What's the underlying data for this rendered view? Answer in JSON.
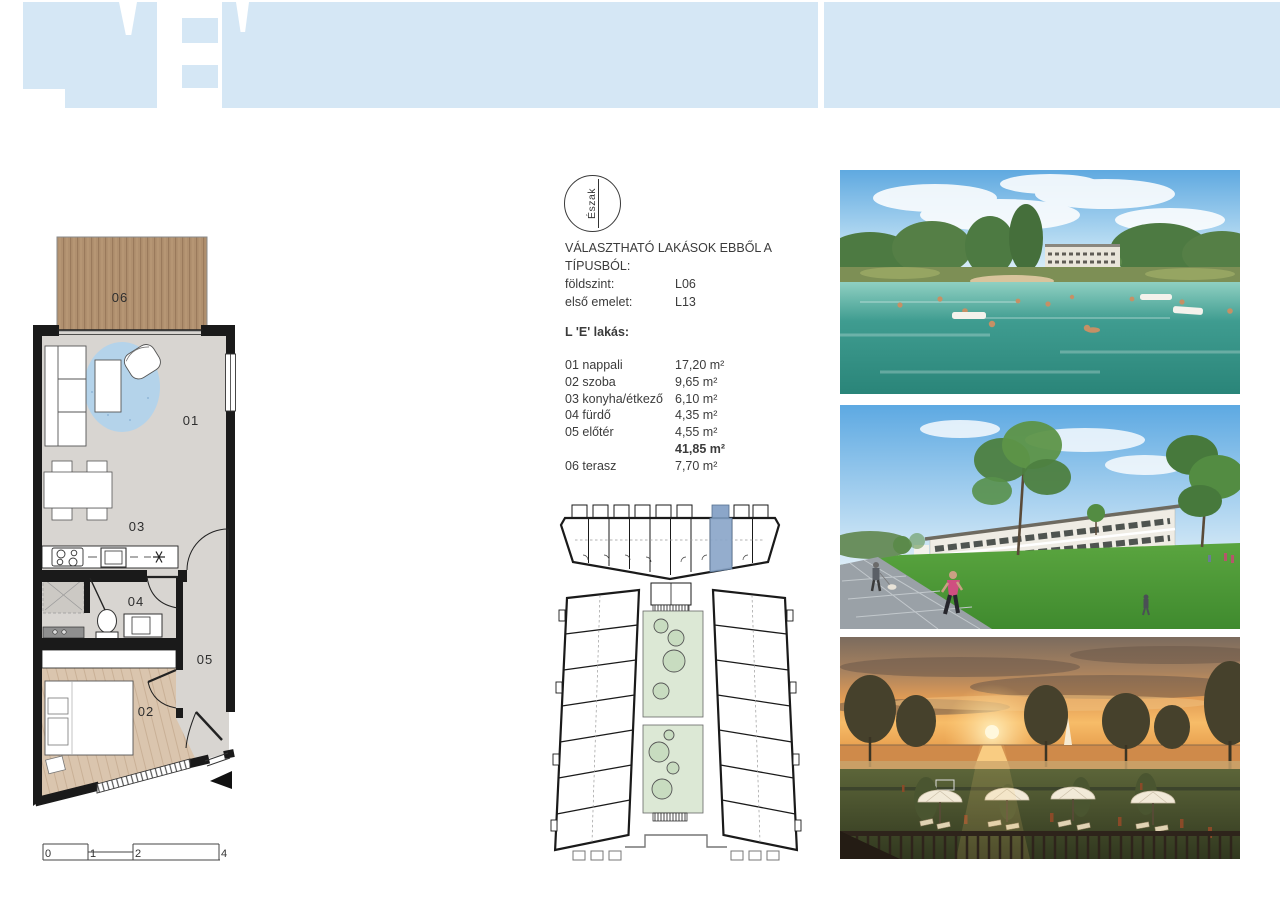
{
  "header": {
    "title": "L'E'",
    "band_color": "#d5e7f5"
  },
  "compass": {
    "label": "Észak"
  },
  "selector": {
    "line1": "VÁLASZTHATÓ LAKÁSOK EBBŐL A",
    "line2": "TÍPUSBÓL:",
    "rows": [
      {
        "label": "földszint:",
        "value": "L06"
      },
      {
        "label": "első emelet:",
        "value": "L13"
      }
    ]
  },
  "apartment": {
    "title": "L 'E' lakás:",
    "rows": [
      {
        "label": "01 nappali",
        "area": "17,20 m²"
      },
      {
        "label": "02 szoba",
        "area": "9,65 m²"
      },
      {
        "label": "03 konyha/étkező",
        "area": "6,10 m²"
      },
      {
        "label": "04 fürdő",
        "area": "4,35 m²"
      },
      {
        "label": "05 előtér",
        "area": "4,55 m²"
      }
    ],
    "total": "41,85 m²",
    "terrace": {
      "label": "06 terasz",
      "area": "7,70 m²"
    }
  },
  "floorplan": {
    "room_labels": {
      "living": "01",
      "bedroom": "02",
      "kitchen": "03",
      "bath": "04",
      "hall": "05",
      "terrace": "06"
    },
    "scalebar": {
      "t0": "0",
      "t1": "1",
      "t2": "2",
      "t4": "4"
    }
  },
  "siteplan": {
    "highlight_color": "#8ba6c9",
    "courtyard_green": "#dce8d5"
  },
  "photos": [
    {
      "alt": "lake bathing render"
    },
    {
      "alt": "apartment building and lawn render"
    },
    {
      "alt": "sunset lakeside terrace render"
    }
  ],
  "colors": {
    "band_blue": "#d5e7f5",
    "wall": "#1a1a1a",
    "wood_terrace": "#b0906f",
    "wood_bedroom": "#dac5ae",
    "rug_blue": "#b4d3ea"
  }
}
